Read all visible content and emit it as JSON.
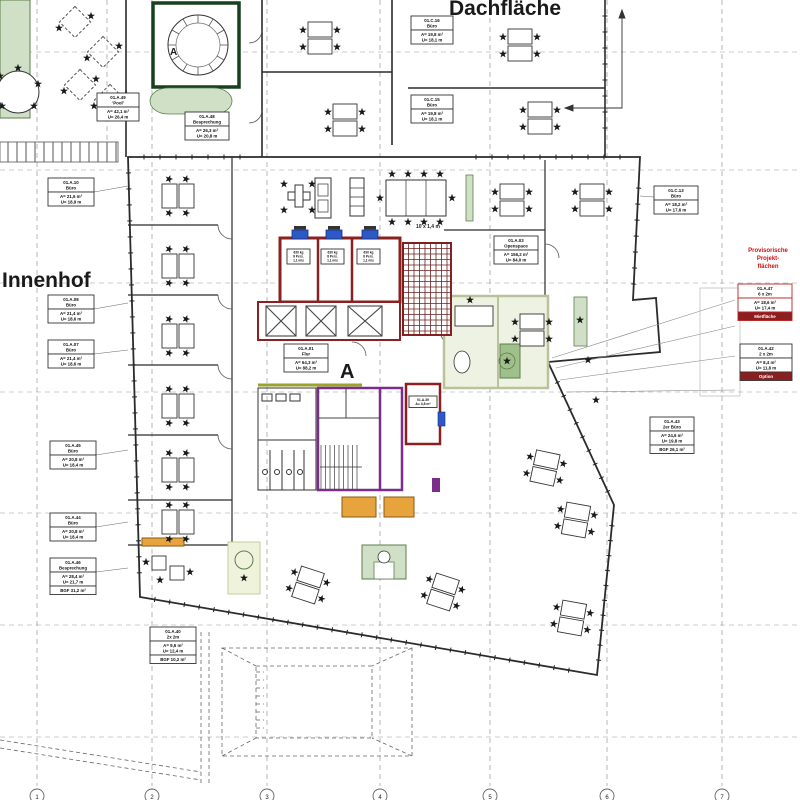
{
  "texts": {
    "dachflaeche": "Dachfläche",
    "innenhof": "Innenhof",
    "pavilion_a": "A",
    "core_a": "A",
    "table_dim": "10 x 1,4 m",
    "red_note": [
      "Provisorische",
      "Projekt-",
      "flächen"
    ]
  },
  "grid": {
    "bubbles": [
      "1",
      "2",
      "3",
      "4",
      "5",
      "6",
      "7"
    ]
  },
  "colors": {
    "wall": "#2b2b2b",
    "red": "#8b2020",
    "red_bright": "#bb2222",
    "note_red": "#cc1111",
    "purple": "#7b2d8b",
    "blue": "#2d59c8",
    "olive": "#9ba22e",
    "orange": "#e8a43c",
    "orange_dark": "#8a5a14",
    "green_light": "#cfe0c6",
    "green_mid": "#9fc08a",
    "green_dark": "#17401f",
    "green_border": "#5f7d4e",
    "pale_room": "#eef2e2",
    "pale_border": "#b9c29a",
    "grid_gray": "#999999"
  },
  "room_labels": [
    {
      "x": 48,
      "y": 178,
      "w": 46,
      "rows": [
        {
          "lines": [
            "01.A.10",
            "Büro"
          ]
        },
        {
          "lines": [
            "A= 21,6 m²",
            "U= 18,9 m"
          ]
        }
      ],
      "lead": [
        128,
        186
      ]
    },
    {
      "x": 48,
      "y": 295,
      "w": 46,
      "rows": [
        {
          "lines": [
            "01.A.08",
            "Büro"
          ]
        },
        {
          "lines": [
            "A= 21,4 m²",
            "U= 18,6 m"
          ]
        }
      ],
      "lead": [
        128,
        303
      ]
    },
    {
      "x": 48,
      "y": 340,
      "w": 46,
      "rows": [
        {
          "lines": [
            "01.A.07",
            "Büro"
          ]
        },
        {
          "lines": [
            "A= 21,4 m²",
            "U= 18,6 m"
          ]
        }
      ],
      "lead": [
        128,
        350
      ]
    },
    {
      "x": 50,
      "y": 441,
      "w": 46,
      "rows": [
        {
          "lines": [
            "01.A.45",
            "Büro"
          ]
        },
        {
          "lines": [
            "A= 20,8 m²",
            "U= 18,4 m"
          ]
        }
      ],
      "lead": [
        128,
        450
      ]
    },
    {
      "x": 50,
      "y": 513,
      "w": 46,
      "rows": [
        {
          "lines": [
            "01.A.44",
            "Büro"
          ]
        },
        {
          "lines": [
            "A= 20,8 m²",
            "U= 18,4 m"
          ]
        }
      ],
      "lead": [
        128,
        522
      ]
    },
    {
      "x": 50,
      "y": 558,
      "w": 46,
      "rows": [
        {
          "lines": [
            "01.A.46",
            "Besprechung"
          ]
        },
        {
          "lines": [
            "A= 28,4 m²",
            "U= 21,7 m"
          ]
        },
        {
          "lines": [
            "BGF 31,2 m²"
          ]
        }
      ],
      "lead": [
        128,
        568
      ]
    },
    {
      "x": 97,
      "y": 93,
      "w": 42,
      "rows": [
        {
          "lines": [
            "01.A.49",
            "'Pool'"
          ]
        },
        {
          "lines": [
            "A= 42,1 m²",
            "U= 26,4 m"
          ]
        }
      ]
    },
    {
      "x": 185,
      "y": 112,
      "w": 44,
      "rows": [
        {
          "lines": [
            "01.A.48",
            "Besprechung"
          ]
        },
        {
          "lines": [
            "A= 26,3 m²",
            "U= 20,8 m"
          ]
        }
      ]
    },
    {
      "x": 411,
      "y": 16,
      "w": 42,
      "rows": [
        {
          "lines": [
            "01.C.16",
            "Büro"
          ]
        },
        {
          "lines": [
            "A= 19,8 m²",
            "U= 18,1 m"
          ]
        }
      ]
    },
    {
      "x": 411,
      "y": 95,
      "w": 42,
      "rows": [
        {
          "lines": [
            "01.C.15",
            "Büro"
          ]
        },
        {
          "lines": [
            "A= 19,8 m²",
            "U= 18,1 m"
          ]
        }
      ]
    },
    {
      "x": 654,
      "y": 186,
      "w": 44,
      "rows": [
        {
          "lines": [
            "01.C.13",
            "Büro"
          ]
        },
        {
          "lines": [
            "A= 18,2 m²",
            "U= 17,6 m"
          ]
        }
      ],
      "lead": [
        640,
        196
      ]
    },
    {
      "x": 494,
      "y": 236,
      "w": 44,
      "rows": [
        {
          "lines": [
            "01.A.03",
            "Openspace"
          ]
        },
        {
          "lines": [
            "A= 156,2 m²",
            "U= 84,0 m"
          ]
        }
      ]
    },
    {
      "x": 284,
      "y": 344,
      "w": 44,
      "rows": [
        {
          "lines": [
            "01.A.01",
            "Flur"
          ]
        },
        {
          "lines": [
            "A= 64,3 m²",
            "U= 88,2 m"
          ]
        }
      ]
    },
    {
      "x": 650,
      "y": 417,
      "w": 44,
      "rows": [
        {
          "lines": [
            "01.A.43",
            "2er Büro"
          ]
        },
        {
          "lines": [
            "A= 24,6 m²",
            "U= 19,8 m"
          ]
        },
        {
          "lines": [
            "BGF 26,1 m²"
          ]
        }
      ]
    },
    {
      "x": 150,
      "y": 627,
      "w": 46,
      "rows": [
        {
          "lines": [
            "01.A.40",
            "2x 2m"
          ]
        },
        {
          "lines": [
            "A= 9,6 m²",
            "U= 12,4 m"
          ]
        },
        {
          "lines": [
            "BGF 10,2 m²"
          ]
        }
      ]
    },
    {
      "x": 738,
      "y": 284,
      "w": 54,
      "border": "#bb2222",
      "rows": [
        {
          "lines": [
            "01.A.47",
            "6 x 2m"
          ]
        },
        {
          "lines": [
            "A= 18,6 m²",
            "U= 17,4 m"
          ]
        },
        {
          "lines": [
            "Mietfläche"
          ],
          "fill": "#8b1f1f",
          "color": "#ffffff"
        }
      ]
    },
    {
      "x": 740,
      "y": 344,
      "w": 52,
      "rows": [
        {
          "lines": [
            "01.A.42",
            "2 x 2m"
          ]
        },
        {
          "lines": [
            "A= 8,4 m²",
            "U= 11,8 m"
          ]
        },
        {
          "lines": [
            "Option"
          ],
          "fill": "#8b1f1f",
          "color": "#ffffff"
        }
      ]
    },
    {
      "x": 287,
      "y": 249,
      "w": 23,
      "fs": 3.2,
      "rows": [
        {
          "lines": [
            "630 kg",
            "8 Pers.",
            "1,1 m/s"
          ]
        }
      ]
    },
    {
      "x": 321,
      "y": 249,
      "w": 23,
      "fs": 3.2,
      "rows": [
        {
          "lines": [
            "630 kg",
            "8 Pers.",
            "1,1 m/s"
          ]
        }
      ]
    },
    {
      "x": 357,
      "y": 249,
      "w": 23,
      "fs": 3.2,
      "rows": [
        {
          "lines": [
            "630 kg",
            "8 Pers.",
            "1,1 m/s"
          ]
        }
      ]
    },
    {
      "x": 409,
      "y": 396,
      "w": 28,
      "fs": 3.4,
      "rows": [
        {
          "lines": [
            "01.A.39",
            "A= 4,8 m²"
          ]
        }
      ]
    }
  ]
}
